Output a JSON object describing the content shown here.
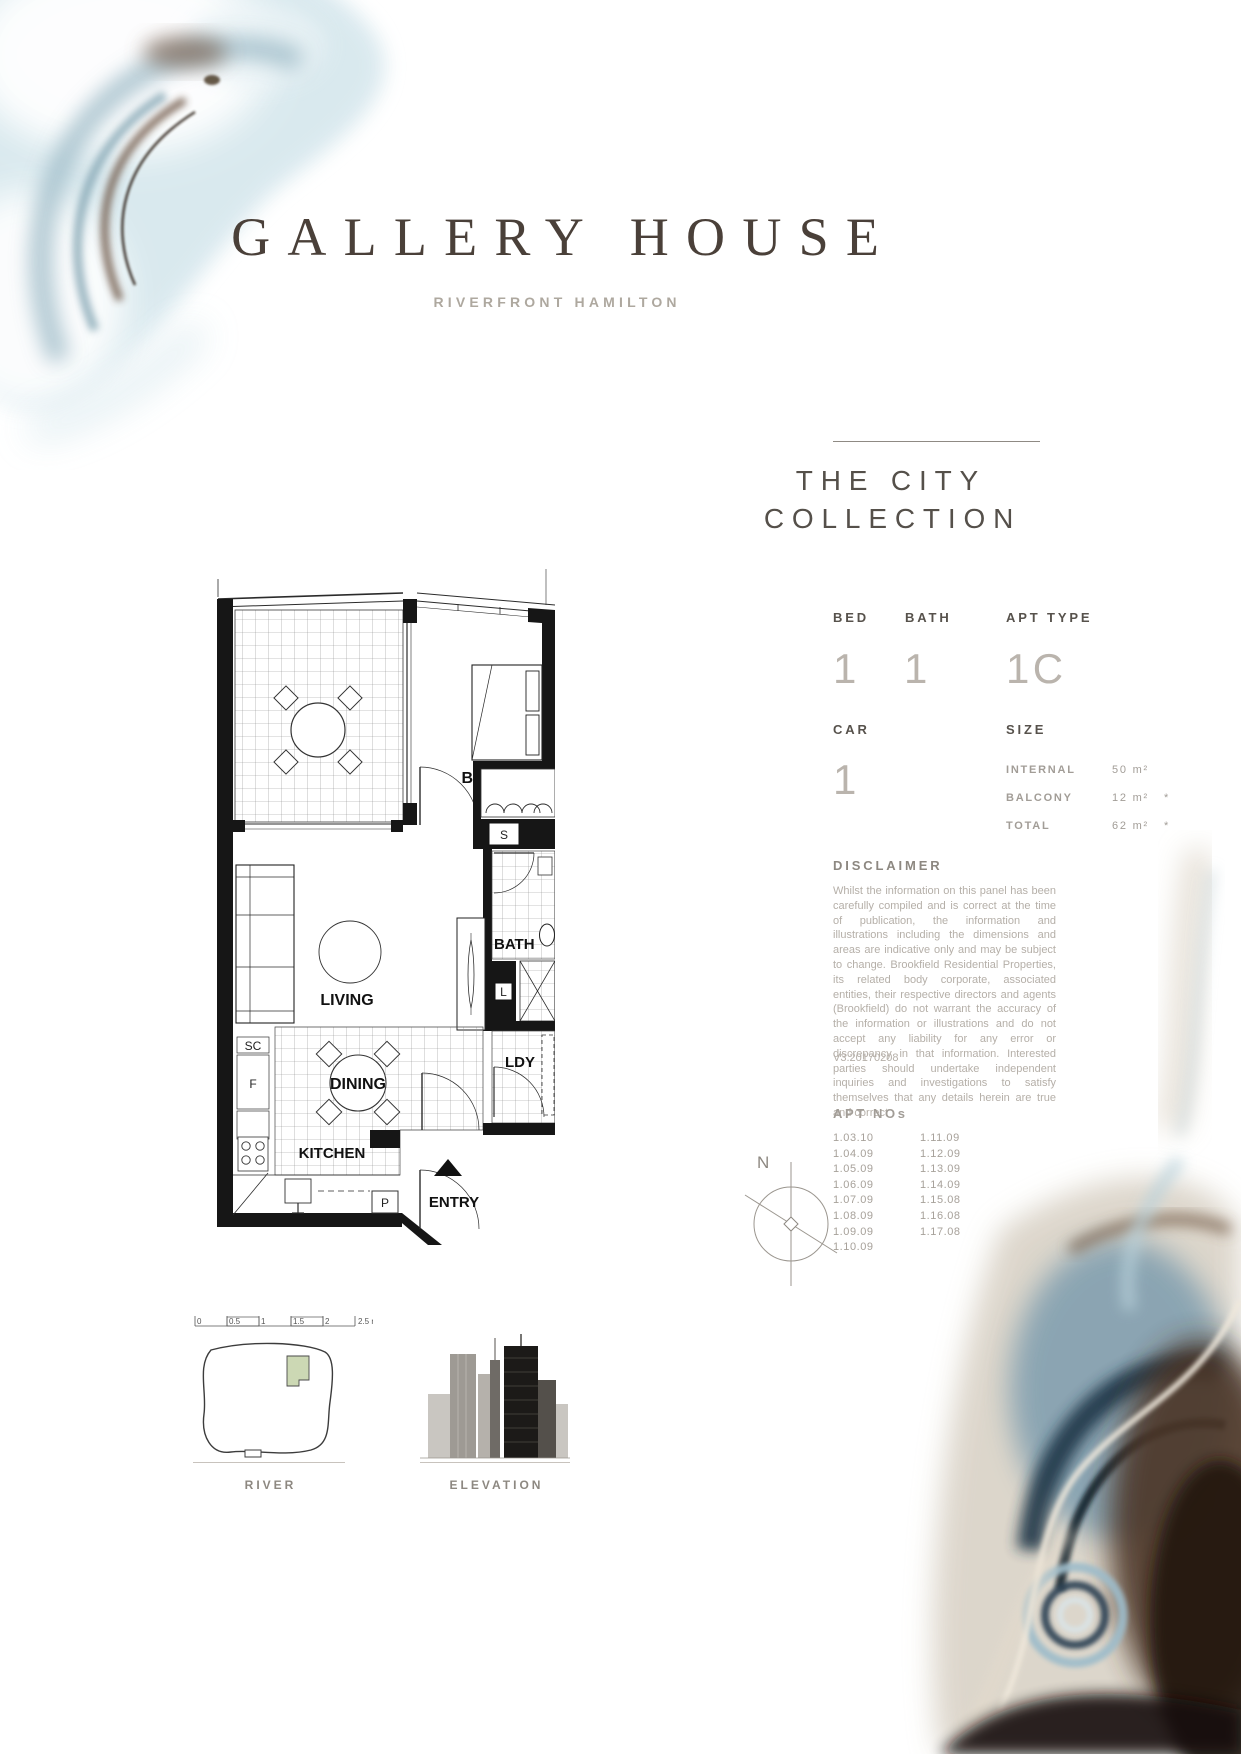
{
  "brand": {
    "title": "GALLERY HOUSE",
    "subtitle": "RIVERFRONT HAMILTON"
  },
  "collection": {
    "line1": "THE CITY",
    "line2": "COLLECTION"
  },
  "specs": {
    "bed": {
      "label": "BED",
      "value": "1"
    },
    "bath": {
      "label": "BATH",
      "value": "1"
    },
    "apt_type": {
      "label": "APT TYPE",
      "value": "1C"
    },
    "car": {
      "label": "CAR",
      "value": "1"
    },
    "size_label": "SIZE",
    "sizes": [
      {
        "label": "INTERNAL",
        "value": "50 m²",
        "note": ""
      },
      {
        "label": "BALCONY",
        "value": "12 m²",
        "note": "*"
      },
      {
        "label": "TOTAL",
        "value": "62 m²",
        "note": "*"
      }
    ]
  },
  "disclaimer": {
    "heading": "DISCLAIMER",
    "body": "Whilst the information on this panel has been carefully compiled and is correct at the time of publication, the information and illustrations including the dimensions and areas are indicative only and may be subject to change. Brookfield Residential Properties, its related body corporate, associated entities, their respective directors and agents (Brookfield) do not warrant the accuracy of the information or illustrations and do not accept any liability for any error or discrepancy in that information. Interested parties should undertake independent inquiries and investigations to satisfy themselves that any details herein are true and correct",
    "version": "V3.20170208"
  },
  "apt_nos": {
    "heading": "APT NOs",
    "col1": [
      "1.03.10",
      "1.04.09",
      "1.05.09",
      "1.06.09",
      "1.07.09",
      "1.08.09",
      "1.09.09",
      "1.10.09"
    ],
    "col2": [
      "1.11.09",
      "1.12.09",
      "1.13.09",
      "1.14.09",
      "1.15.08",
      "1.16.08",
      "1.17.08"
    ]
  },
  "floorplan": {
    "labels": {
      "bed1": "BED 1",
      "s": "S",
      "bath": "BATH",
      "living": "LIVING",
      "sc": "SC",
      "f": "F",
      "dining": "DINING",
      "ldy": "LDY",
      "l": "L",
      "kitchen": "KITCHEN",
      "p": "P",
      "entry": "ENTRY"
    }
  },
  "scalebar": {
    "labels": [
      "0",
      "0.5",
      "1",
      "1.5",
      "2"
    ],
    "end_label": "2.5 metres"
  },
  "compass": {
    "label": "N"
  },
  "thumbnails": {
    "river_label": "RIVER",
    "elevation_label": "ELEVATION"
  },
  "colors": {
    "title_brown": "#4a4039",
    "text_dark": "#56514b",
    "text_light": "#bab4ad",
    "text_mid": "#a29d97",
    "plan_green": "#ccd8b4",
    "line": "#8f8a84"
  }
}
